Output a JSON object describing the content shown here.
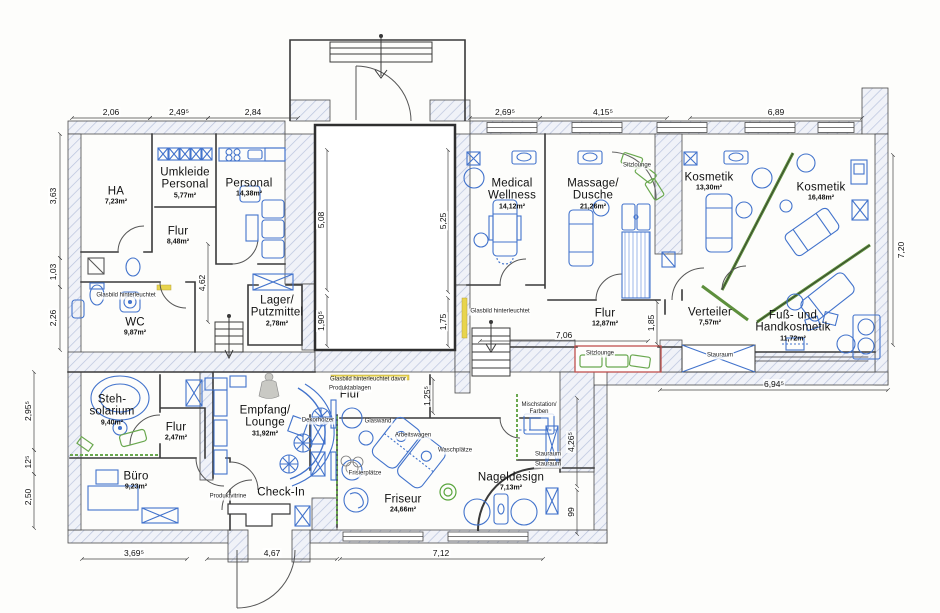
{
  "rooms": [
    {
      "name": "HA",
      "area": "7,23m²"
    },
    {
      "name": "Umkleide\nPersonal",
      "area": "5,77m²"
    },
    {
      "name": "Personal",
      "area": "14,38m²"
    },
    {
      "name": "Flur",
      "area": "8,48m²"
    },
    {
      "name": "WC",
      "area": "9,87m²"
    },
    {
      "name": "Lager/\nPutzmittel",
      "area": "2,78m²"
    },
    {
      "name": "Steh-\nsolarium",
      "area": "9,40m²"
    },
    {
      "name": "Flur",
      "area": "2,47m²"
    },
    {
      "name": "Büro",
      "area": "9,23m²"
    },
    {
      "name": "Empfang/\nLounge",
      "area": "31,92m²"
    },
    {
      "name": "Check-In",
      "area": ""
    },
    {
      "name": "Friseur",
      "area": "24,66m²"
    },
    {
      "name": "Nageldesign",
      "area": "7,13m²"
    },
    {
      "name": "Flur",
      "area": ""
    },
    {
      "name": "Medical\nWellness",
      "area": "14,12m²"
    },
    {
      "name": "Massage/\nDusche",
      "area": "21,26m²"
    },
    {
      "name": "Kosmetik",
      "area": "13,30m²"
    },
    {
      "name": "Kosmetik",
      "area": "16,48m²"
    },
    {
      "name": "Flur",
      "area": "12,87m²"
    },
    {
      "name": "Verteiler",
      "area": "7,57m²"
    },
    {
      "name": "Fuß- und\nHandkosmetik",
      "area": "11,72m²"
    }
  ],
  "annotations": [
    "Glasbild hinterleuchtet",
    "Glasbild hinterleuchtet",
    "Glasbild hinterleuchtet davor",
    "Produktablagen",
    "Produktvitrine",
    "Dekorhölzer",
    "Glaswand",
    "Arbeitswagen",
    "Waschplätze",
    "Frisierplätze",
    "Mischstation/\nFarben",
    "Sitzlounge",
    "Sitzlounge",
    "Stauraum",
    "Stauraum",
    "Stauraum"
  ],
  "dimensions": {
    "top": [
      "2,06",
      "2,49⁵",
      "2,84",
      "2,69⁵",
      "4,15⁵",
      "6,89"
    ],
    "left": [
      "3,63",
      "1,03",
      "2,26",
      "2,95⁵",
      "12⁵",
      "2,50"
    ],
    "bottom": [
      "3,69⁵",
      "4,67",
      "7,12"
    ],
    "right": [
      "7,20"
    ],
    "inner": [
      "5,08",
      "5,25",
      "1,90⁵",
      "1,75",
      "4,62",
      "7,06",
      "1,85",
      "6,94⁵",
      "1,25⁵",
      "4,26⁵",
      "99"
    ]
  },
  "colors": {
    "wall_hatch": "#c7cfe6",
    "furniture": "#4273cc",
    "wellness_green": "#6aa84f",
    "sitzlounge_red": "#c0504d",
    "backlit_yellow": "#e8d44d",
    "wall_line": "#3a3a3a"
  }
}
